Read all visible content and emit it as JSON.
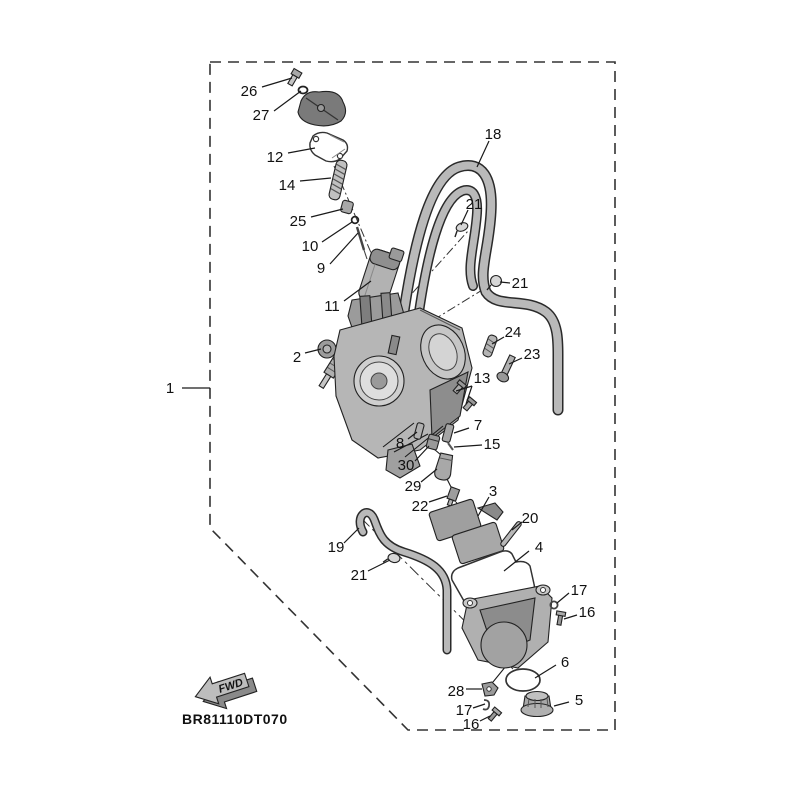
{
  "diagram": {
    "code": "BR81110DT070",
    "fwd": "FWD"
  },
  "callouts": [
    {
      "label": "26"
    },
    {
      "label": "27"
    },
    {
      "label": "12"
    },
    {
      "label": "14"
    },
    {
      "label": "25"
    },
    {
      "label": "10"
    },
    {
      "label": "9"
    },
    {
      "label": "11"
    },
    {
      "label": "2"
    },
    {
      "label": "1"
    },
    {
      "label": "18"
    },
    {
      "label": "21"
    },
    {
      "label": "21"
    },
    {
      "label": "24"
    },
    {
      "label": "23"
    },
    {
      "label": "13"
    },
    {
      "label": "7"
    },
    {
      "label": "15"
    },
    {
      "label": "8"
    },
    {
      "label": "30"
    },
    {
      "label": "29"
    },
    {
      "label": "22"
    },
    {
      "label": "3"
    },
    {
      "label": "20"
    },
    {
      "label": "4"
    },
    {
      "label": "19"
    },
    {
      "label": "21"
    },
    {
      "label": "17"
    },
    {
      "label": "16"
    },
    {
      "label": "6"
    },
    {
      "label": "5"
    },
    {
      "label": "28"
    },
    {
      "label": "17"
    },
    {
      "label": "16"
    }
  ],
  "colors": {
    "background": "#ffffff",
    "line": "#1a1a1a",
    "metal_light": "#d4d4d4",
    "metal_mid": "#b5b5b5",
    "metal_dark": "#7a7a7a"
  }
}
